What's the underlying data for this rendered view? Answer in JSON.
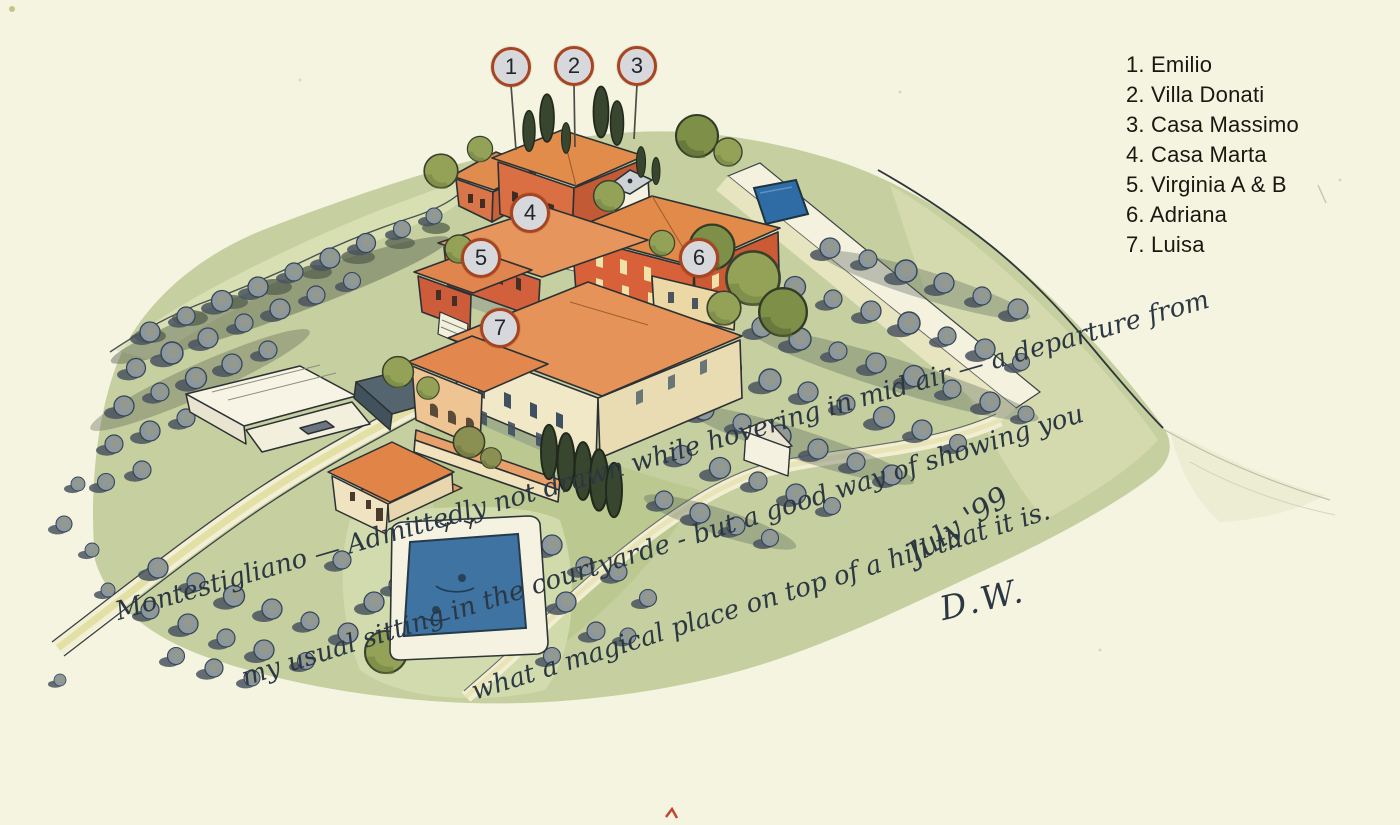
{
  "map": {
    "place": "Montestigliano",
    "legend": {
      "items": [
        "1. Emilio",
        "2. Villa Donati",
        "3. Casa Massimo",
        "4. Casa Marta",
        "5. Virginia A & B",
        "6. Adriana",
        "7. Luisa"
      ]
    },
    "markers": [
      {
        "number": "1",
        "name": "Emilio"
      },
      {
        "number": "2",
        "name": "Villa Donati"
      },
      {
        "number": "3",
        "name": "Casa Massimo"
      },
      {
        "number": "4",
        "name": "Casa Marta"
      },
      {
        "number": "5",
        "name": "Virginia A & B"
      },
      {
        "number": "6",
        "name": "Adriana"
      },
      {
        "number": "7",
        "name": "Luisa"
      }
    ],
    "caption": {
      "line1": "Montestigliano — Admittedly not drawn while hovering in mid air — a departure from",
      "line2": "my usual sitting in the courtyarde - but a good way of showing you",
      "line3": "what a magical place on top of a hill that it is.",
      "date": "July '99",
      "signature": "D.W."
    },
    "colors": {
      "paper": "#f5f4e1",
      "hill_green": "#c6cf9f",
      "roof_terracotta": "#e08a4c",
      "wall_red": "#d8663c",
      "wall_cream": "#f1e8c8",
      "pool_blue": "#3f73a1",
      "olive_gray": "#8a97a0",
      "cypress_green": "#39462f",
      "marker_fill": "#d6d8dc",
      "marker_ring": "#a84420",
      "ink": "#2c3337"
    }
  }
}
